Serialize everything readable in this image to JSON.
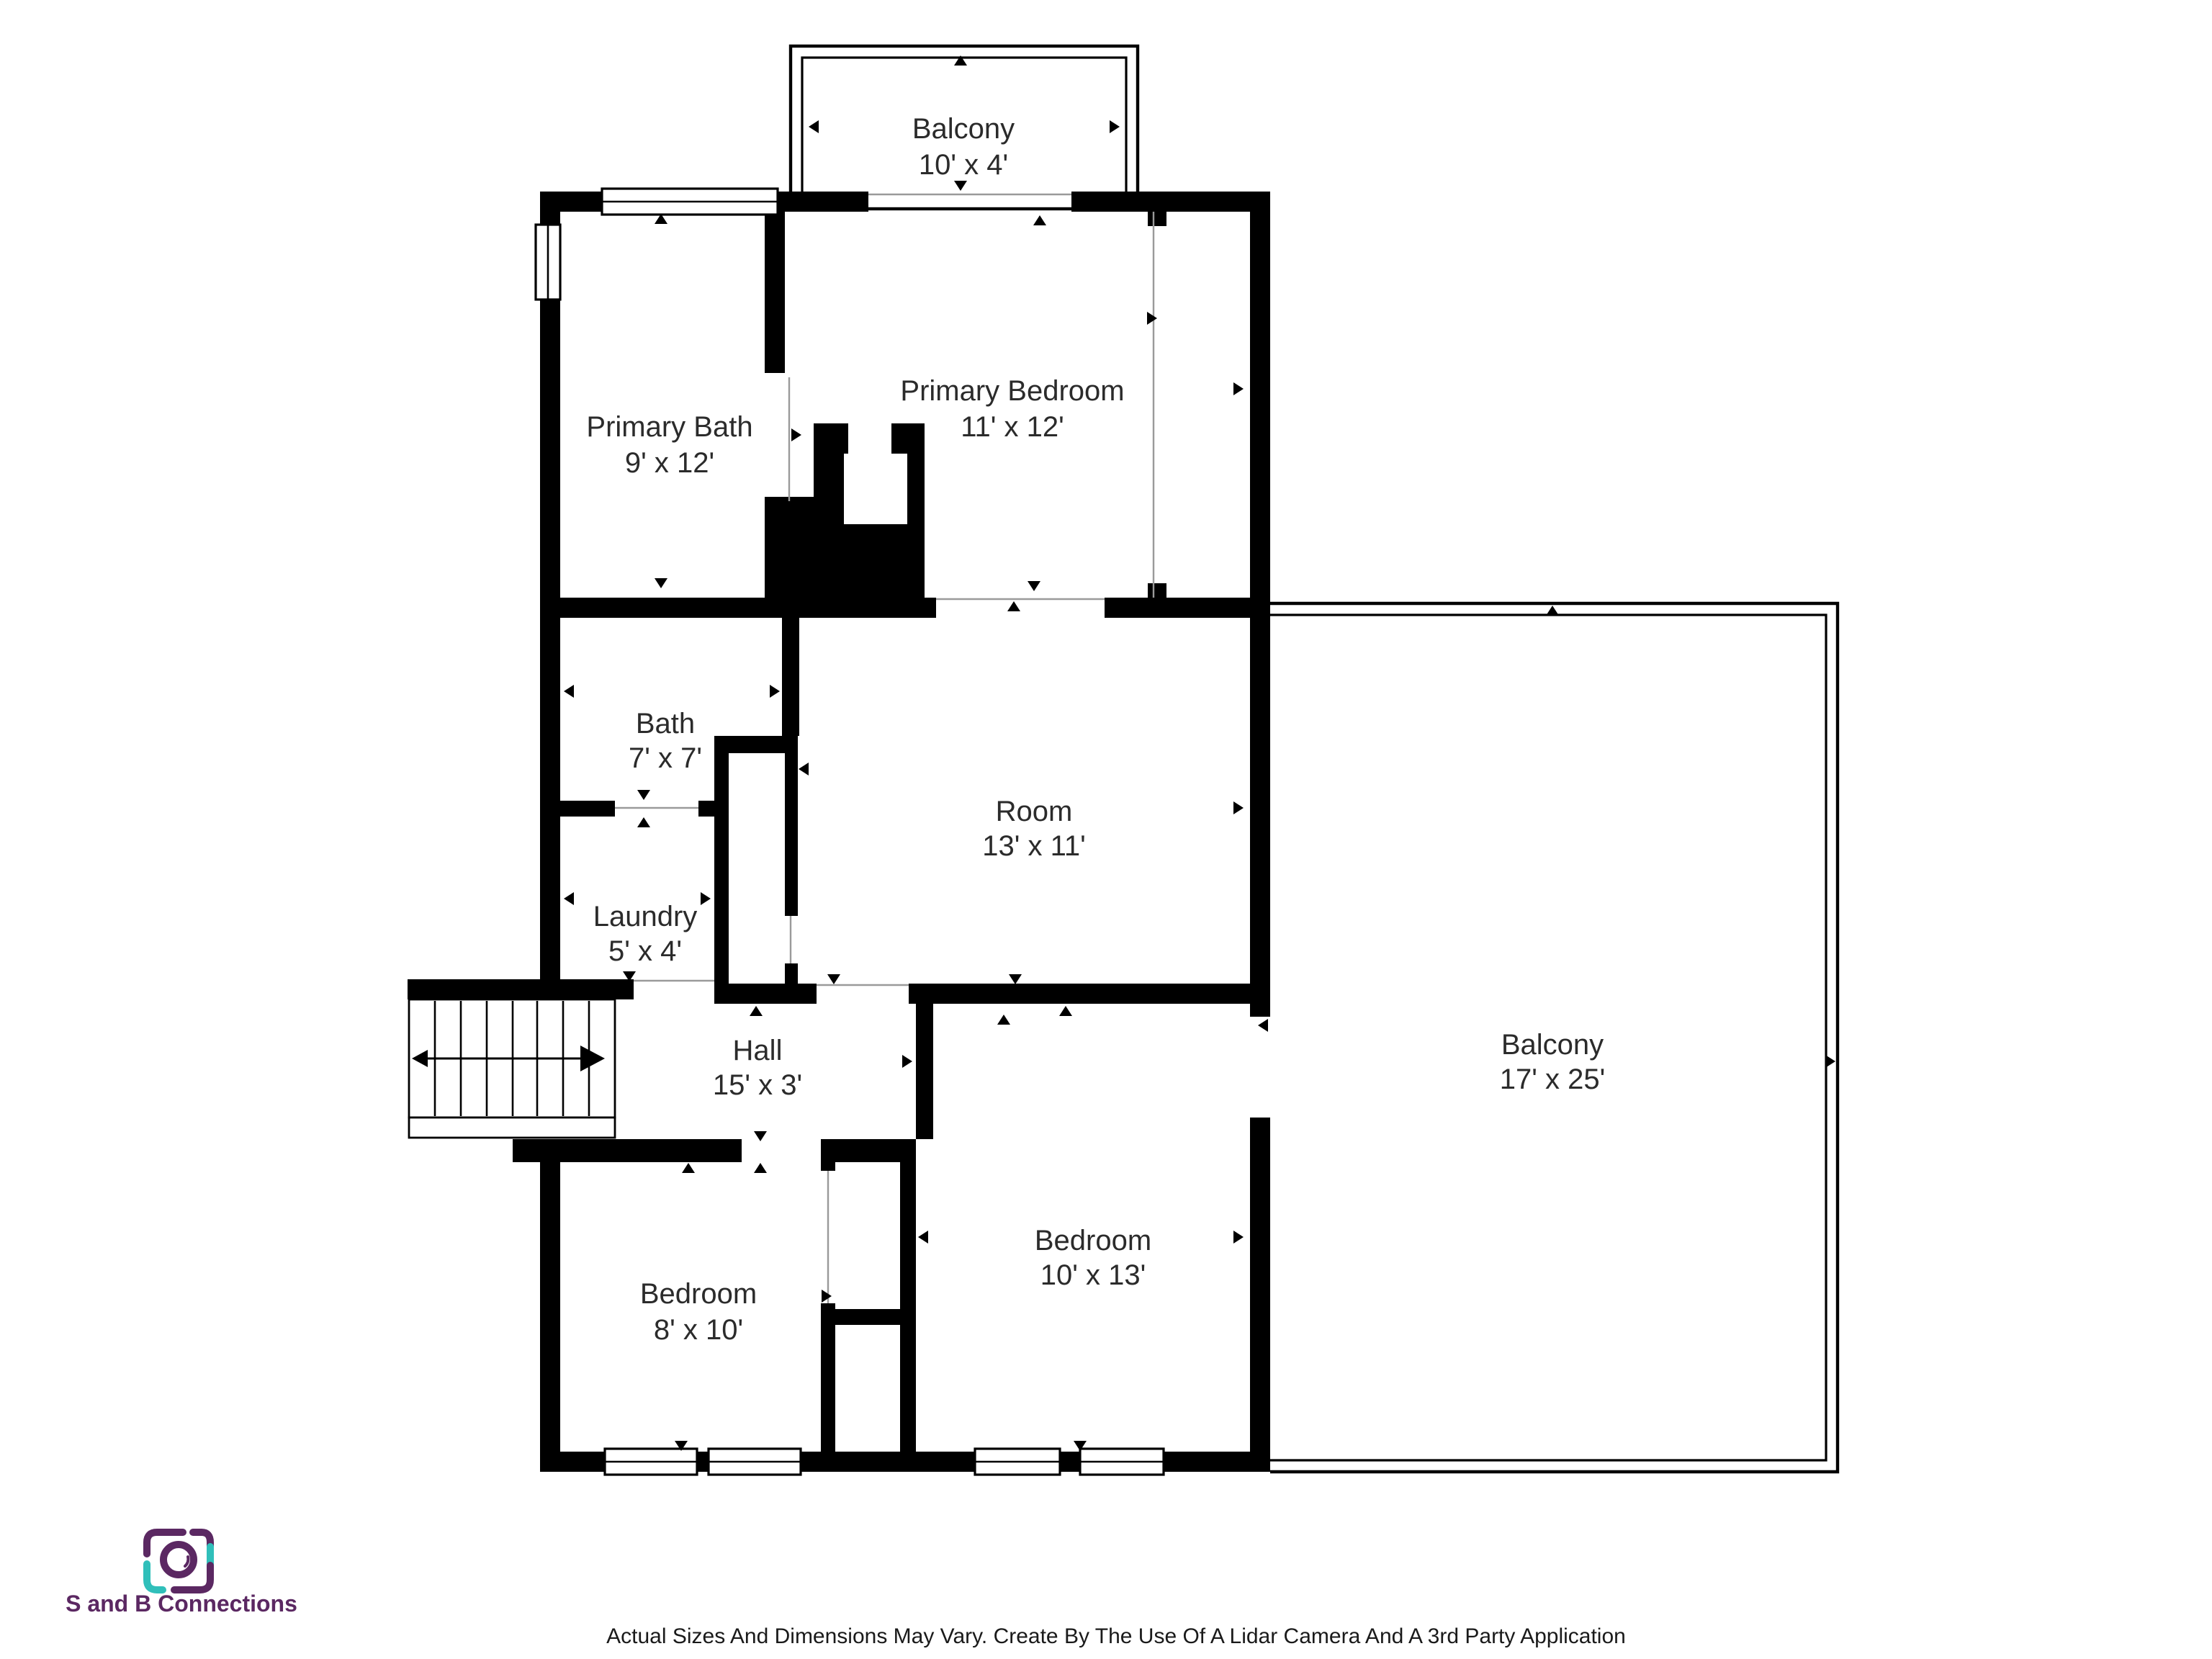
{
  "plan": {
    "wall_color": "#000000",
    "label_color": "#2b2b2b",
    "background": "#ffffff"
  },
  "rooms": [
    {
      "name": "Balcony",
      "dims": "10' x 4'"
    },
    {
      "name": "Primary Bath",
      "dims": "9' x 12'"
    },
    {
      "name": "Primary Bedroom",
      "dims": "11' x 12'"
    },
    {
      "name": "Bath",
      "dims": "7' x 7'"
    },
    {
      "name": "Room",
      "dims": "13' x 11'"
    },
    {
      "name": "Laundry",
      "dims": "5' x 4'"
    },
    {
      "name": "Hall",
      "dims": "15' x 3'"
    },
    {
      "name": "Bedroom",
      "dims": "8' x 10'"
    },
    {
      "name": "Bedroom",
      "dims": "10' x 13'"
    },
    {
      "name": "Balcony",
      "dims": "17' x 25'"
    }
  ],
  "branding": {
    "name": "S and B Connections",
    "icon": "camera-icon",
    "purple": "#5b2862",
    "teal": "#30bfba"
  },
  "footer": {
    "disclaimer": "Actual Sizes And Dimensions May Vary. Create By The Use Of A Lidar Camera And A 3rd Party Application"
  }
}
